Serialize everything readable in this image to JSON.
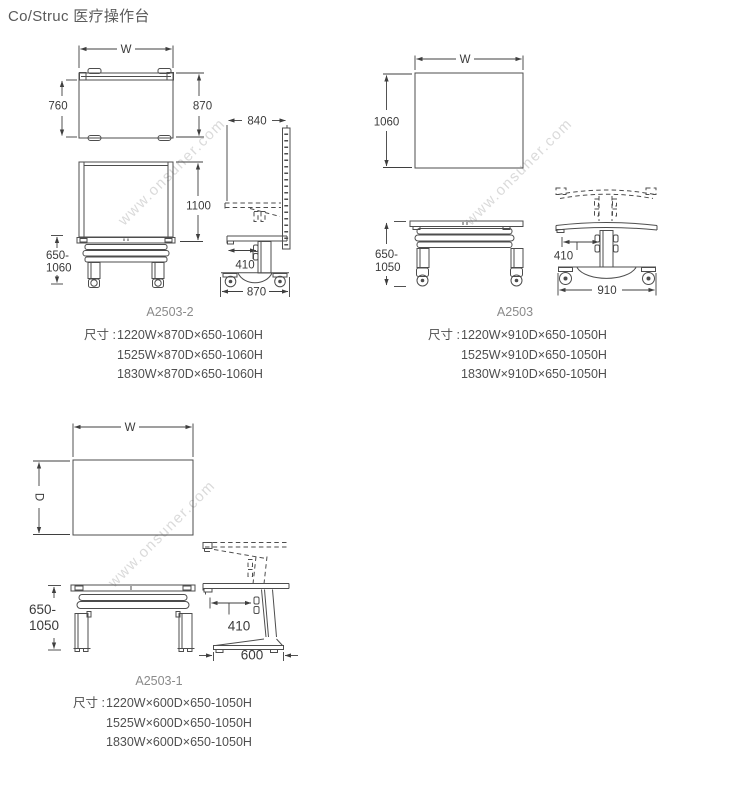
{
  "page": {
    "title": "Co/Struc 医疗操作台"
  },
  "watermark": "www.onsuner.com",
  "groups": [
    {
      "model": "A2503-2",
      "spec_label": "尺寸 :",
      "specs": [
        "1220W×870D×650-1060H",
        "1525W×870D×650-1060H",
        "1830W×870D×650-1060H"
      ],
      "dims": {
        "width": "W",
        "top_depth": "760",
        "top_depth_total": "870",
        "panel_depth": "840",
        "panel_height": "1100",
        "height_min": "650-",
        "height_max": "1060",
        "worktop_depth": "410",
        "base_depth": "870"
      }
    },
    {
      "model": "A2503",
      "spec_label": "尺寸 :",
      "specs": [
        "1220W×910D×650-1050H",
        "1525W×910D×650-1050H",
        "1830W×910D×650-1050H"
      ],
      "dims": {
        "width": "W",
        "top_depth": "1060",
        "height_min": "650-",
        "height_max": "1050",
        "worktop_depth": "410",
        "base_depth": "910"
      }
    },
    {
      "model": "A2503-1",
      "spec_label": "尺寸 :",
      "specs": [
        "1220W×600D×650-1050H",
        "1525W×600D×650-1050H",
        "1830W×600D×650-1050H"
      ],
      "dims": {
        "width": "W",
        "depth": "D",
        "height_min": "650-",
        "height_max": "1050",
        "worktop_depth": "410",
        "base_depth": "600"
      }
    }
  ]
}
